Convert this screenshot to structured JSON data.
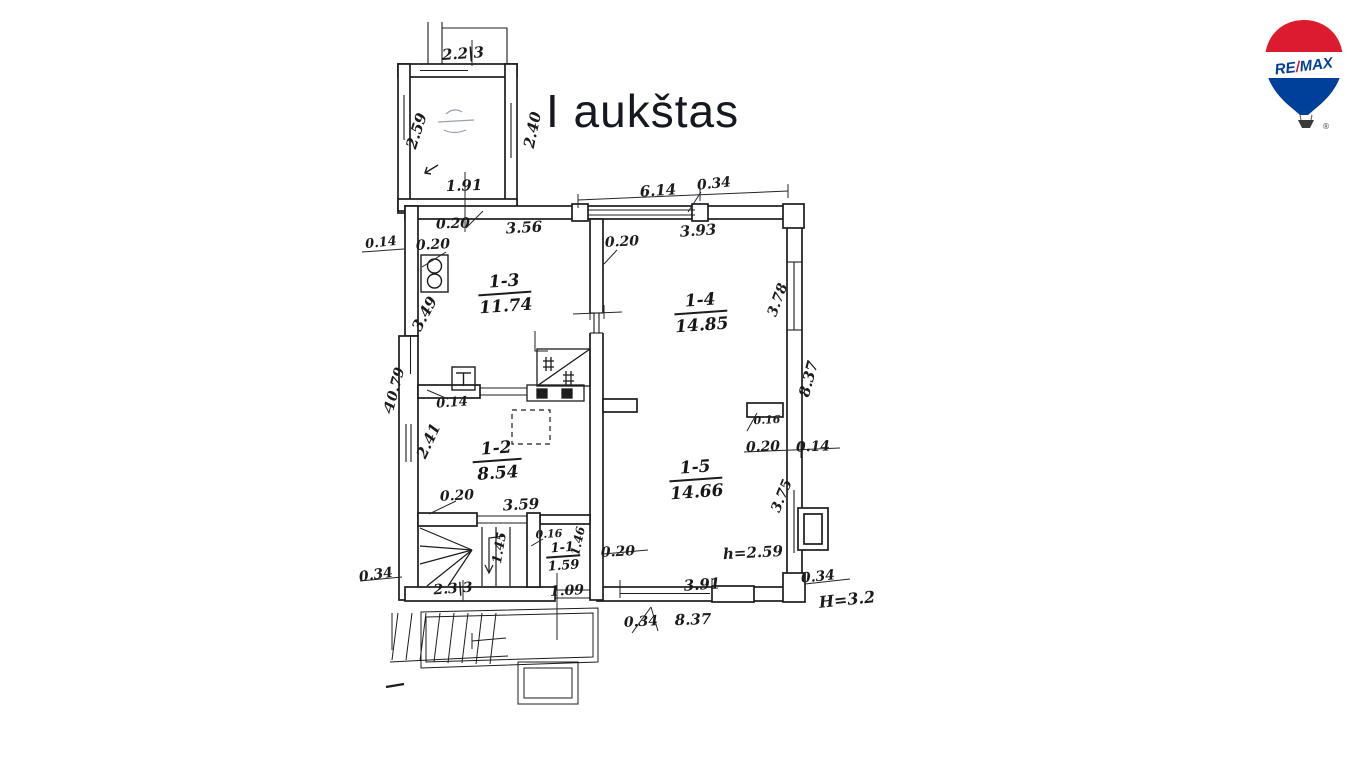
{
  "title": "I aukštas",
  "logo": {
    "re": "RE",
    "slash": "/",
    "max": "MAX",
    "registered": "®",
    "red": "#DC1C2E",
    "blue": "#00409A"
  },
  "rooms": [
    {
      "label": "1-3",
      "area": "11.74"
    },
    {
      "label": "1-4",
      "area": "14.85"
    },
    {
      "label": "1-2",
      "area": "8.54"
    },
    {
      "label": "1-5",
      "area": "14.66"
    },
    {
      "label": "1-1",
      "area": "1.59"
    }
  ],
  "dims": {
    "veranda_top": "2.2|3",
    "veranda_left": "2.59",
    "veranda_right": "2.40",
    "veranda_bottom": "1.91",
    "veranda_wall": "0.20",
    "top_356": "3.56",
    "top_614": "6.14",
    "top_034": "0.34",
    "top_393": "3.93",
    "partition_top_020": "0.20",
    "left_014": "0.14",
    "left_020_top": "0.20",
    "left_349": "3.49",
    "left_total_1079": "10.79",
    "partition_014": "0.14",
    "left_241": "2.41",
    "left_020_low": "0.20",
    "stair_359": "3.59",
    "stair_145": "1.45",
    "hall_016": "0.16",
    "hall_146": "1.46",
    "hall_109": "1.09",
    "hall_020": "0.20",
    "bottom_233": "2.3|3",
    "left_034": "0.34",
    "bottom_391": "3.91",
    "bottom_034": "0.34",
    "bottom_837": "8.37",
    "right_034": "0.34",
    "ceiling_h": "h=2.59",
    "ceiling_H": "H=3.2",
    "right_378": "3.78",
    "right_837": "8.37",
    "right_016": "0.16",
    "right_020": "0.20",
    "right_014": "0.14",
    "right_375": "3.75"
  }
}
